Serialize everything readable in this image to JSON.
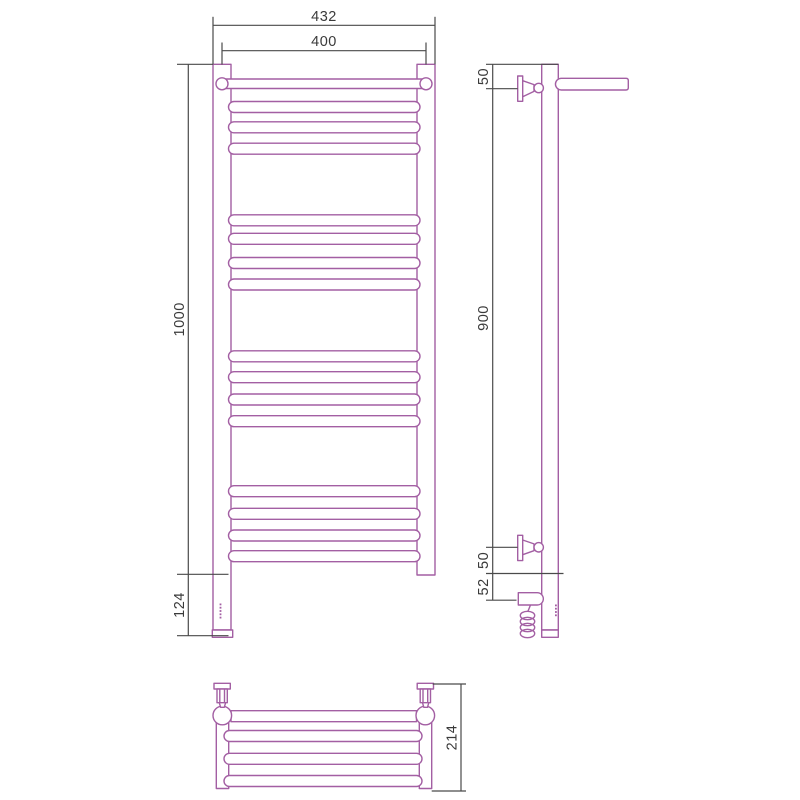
{
  "drawing": {
    "subject": "heated towel rail dimensional drawing, three orthographic views",
    "colors": {
      "product_outline": "#A35FA3",
      "dimension_line": "#4A4A4A",
      "dimension_text": "#3A3A3A",
      "background": "#FFFFFF"
    },
    "front_view": {
      "label_width_overall": "432",
      "label_width_axes": "400",
      "label_height": "1000",
      "label_element_drop": "124",
      "rung_centers_y": [
        107,
        127.3,
        148.7,
        220.3,
        238.8,
        263,
        284.5,
        356.3,
        377.2,
        399.5,
        421.2,
        491.2,
        513.8,
        535.5,
        556.2
      ]
    },
    "side_view": {
      "label_top_bracket_offset": "50",
      "label_bracket_span": "900",
      "label_bottom_bracket_offset": "50",
      "label_element_offset": "52",
      "coil_loop_centers_y": [
        615.5,
        621.5,
        627.5,
        633.5
      ]
    },
    "bottom_view": {
      "label_depth": "214",
      "bar_centers_y": [
        736,
        758.8,
        781
      ]
    }
  }
}
